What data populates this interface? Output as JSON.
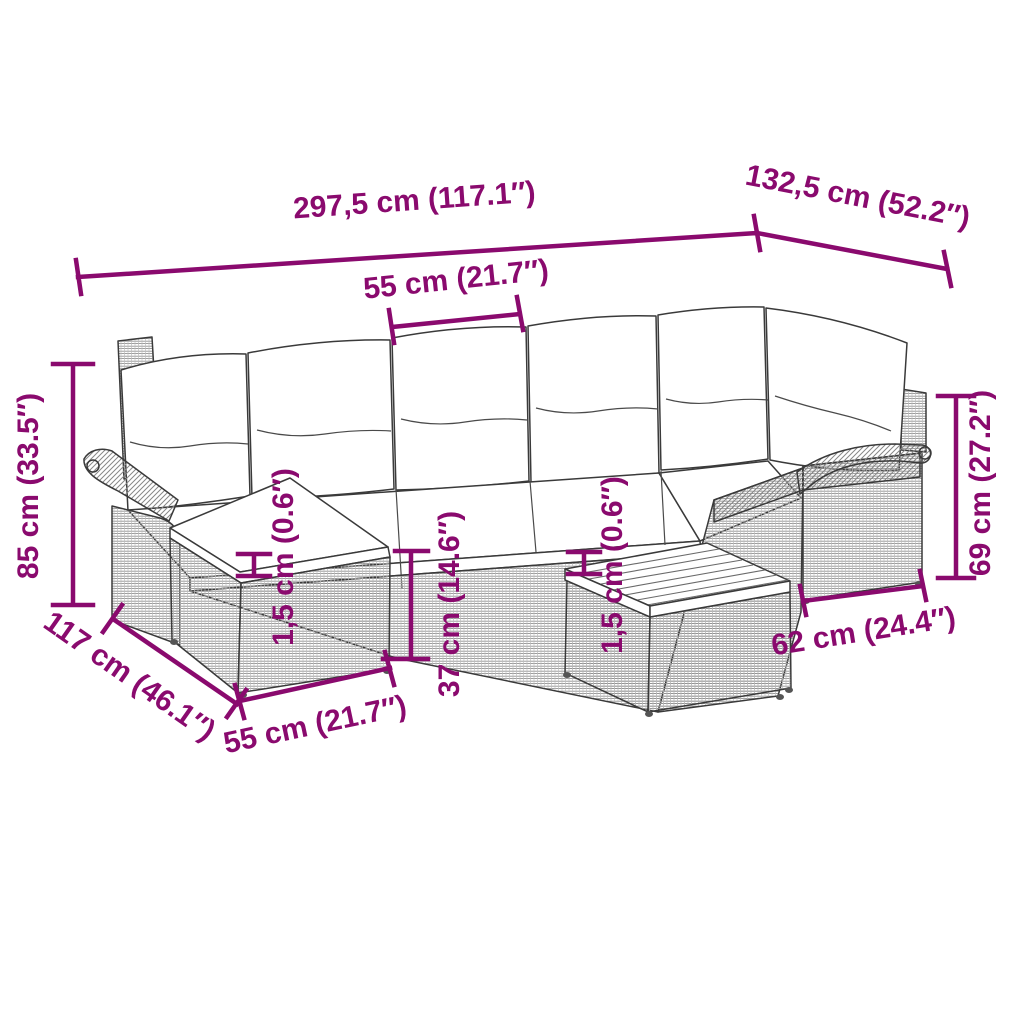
{
  "accent_color": "#8a0a6e",
  "art_colors": {
    "outline": "#3a3a3a",
    "weave_hatch": "#909090",
    "diagonal_hatch": "#878787"
  },
  "subject": "rattan corner sofa set with back cushions, footstool and slatted coffee table",
  "dimensions": {
    "overall_width": "297,5 cm (117.1″)",
    "right_depth": "132,5 cm (52.2″)",
    "seat_width": "55 cm (21.7″)",
    "overall_height": "85 cm (33.5″)",
    "chaise_depth": "117 cm (46.1″)",
    "footstool_width": "55 cm (21.7″)",
    "seat_height": "37 cm (14.6″)",
    "cushion_thickness": "1,5 cm (0.6″)",
    "tabletop_thickness": "1,5 cm (0.6″)",
    "backrest_height": "69 cm (27.2″)",
    "right_module_width": "62 cm (24.4″)"
  }
}
